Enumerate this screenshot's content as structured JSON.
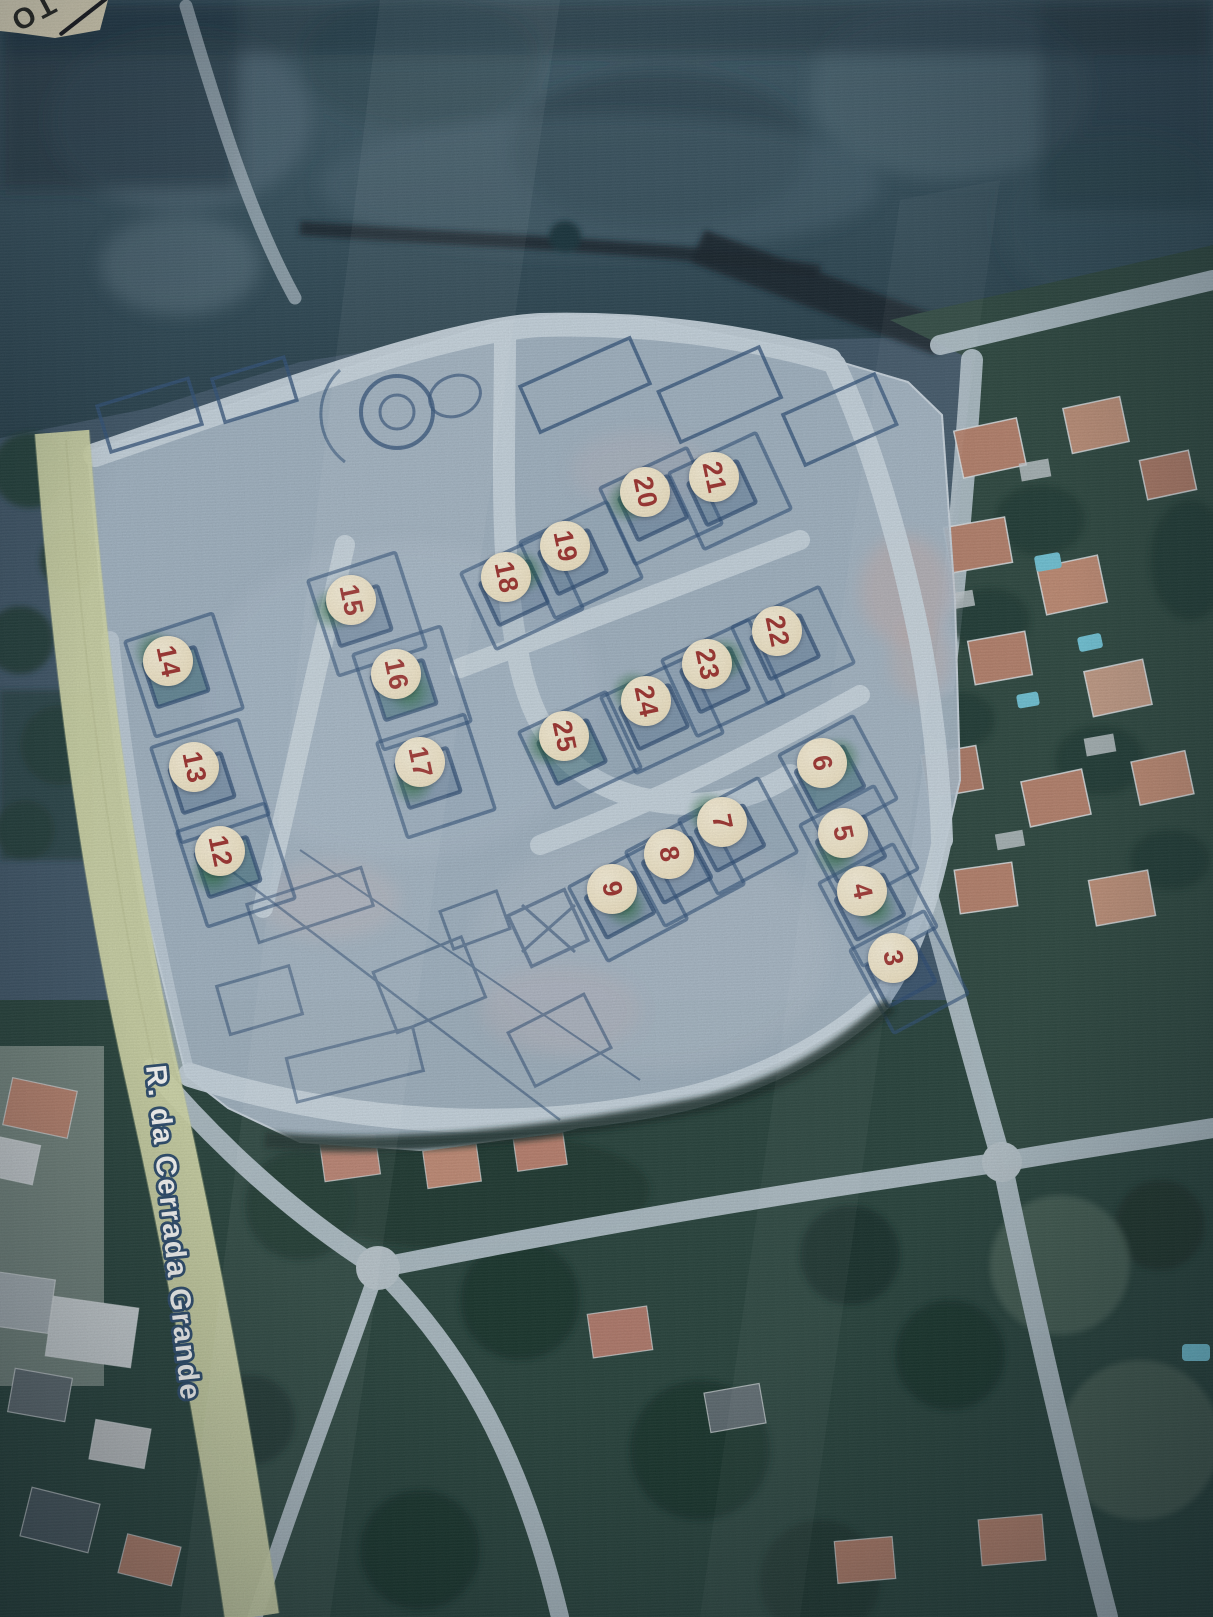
{
  "map": {
    "street_label": "R. da Cerrada Grande",
    "corner_label": "TO",
    "marker_style": {
      "diameter_px": 50,
      "number_rotation_deg": 78
    },
    "colors": {
      "plan_overlay": "#a9bac9",
      "plan_ink": "#2d4e78",
      "plan_road": "#c9d6e0",
      "marker_bg": "#f1e5c6",
      "marker_number": "#9e312d",
      "marker_glow": "#2d6e44",
      "road_yellow": "#d9ddb2",
      "street_label_fill": "#fdfdfb",
      "street_label_outline": "#2a4a6b",
      "aerial_field": "#2a4350",
      "vegetation": "#1d3a31",
      "roof_terracotta": "#b5806b",
      "pool_blue": "#6fc3d6",
      "corner_card": "#f0e6c6"
    },
    "markers": [
      {
        "label": "3",
        "x": 893,
        "y": 958,
        "glow": false
      },
      {
        "label": "4",
        "x": 862,
        "y": 891,
        "glow": true
      },
      {
        "label": "5",
        "x": 843,
        "y": 833,
        "glow": true
      },
      {
        "label": "6",
        "x": 822,
        "y": 763,
        "glow": true
      },
      {
        "label": "7",
        "x": 722,
        "y": 822,
        "glow": true
      },
      {
        "label": "8",
        "x": 669,
        "y": 854,
        "glow": false
      },
      {
        "label": "9",
        "x": 612,
        "y": 889,
        "glow": true
      },
      {
        "label": "12",
        "x": 220,
        "y": 851,
        "glow": true
      },
      {
        "label": "13",
        "x": 194,
        "y": 767,
        "glow": false
      },
      {
        "label": "14",
        "x": 168,
        "y": 661,
        "glow": true
      },
      {
        "label": "15",
        "x": 351,
        "y": 600,
        "glow": true
      },
      {
        "label": "16",
        "x": 396,
        "y": 674,
        "glow": true
      },
      {
        "label": "17",
        "x": 420,
        "y": 762,
        "glow": true
      },
      {
        "label": "18",
        "x": 506,
        "y": 577,
        "glow": true
      },
      {
        "label": "19",
        "x": 565,
        "y": 546,
        "glow": false
      },
      {
        "label": "20",
        "x": 645,
        "y": 492,
        "glow": true
      },
      {
        "label": "21",
        "x": 714,
        "y": 477,
        "glow": false
      },
      {
        "label": "22",
        "x": 777,
        "y": 631,
        "glow": false
      },
      {
        "label": "23",
        "x": 707,
        "y": 664,
        "glow": true
      },
      {
        "label": "24",
        "x": 646,
        "y": 701,
        "glow": true
      },
      {
        "label": "25",
        "x": 564,
        "y": 736,
        "glow": true
      }
    ]
  }
}
